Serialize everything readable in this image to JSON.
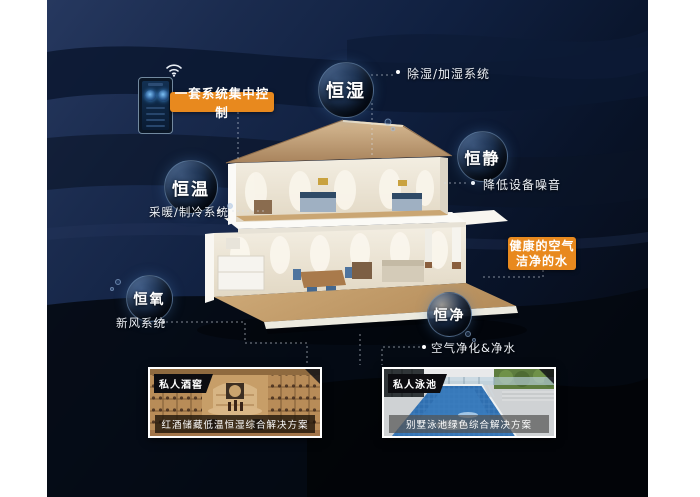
{
  "bubbles": {
    "humidity": {
      "label": "恒湿"
    },
    "quiet": {
      "label": "恒静"
    },
    "temperature": {
      "label": "恒温"
    },
    "oxygen": {
      "label": "恒氧"
    },
    "clean": {
      "label": "恒净"
    }
  },
  "notes": {
    "humidity": "除湿/加湿系统",
    "quiet": "降低设备噪音",
    "temperature": "采暖/制冷系统",
    "oxygen": "新风系统",
    "clean": "空气净化&净水"
  },
  "callouts": {
    "central_control": "一套系统集中控制",
    "healthy_air_line1": "健康的空气",
    "healthy_air_line2": "洁净的水"
  },
  "photos": {
    "wine_cellar": {
      "tag": "私人酒窖",
      "caption": "红酒储藏低温恒湿综合解决方案"
    },
    "pool": {
      "tag": "私人泳池",
      "caption": "别墅泳池绿色综合解决方案"
    }
  },
  "colors": {
    "accent_orange": "#E8891E",
    "background_navy": "#17274A",
    "panel_black": "#05090F",
    "line_white": "#D7DEE8"
  }
}
